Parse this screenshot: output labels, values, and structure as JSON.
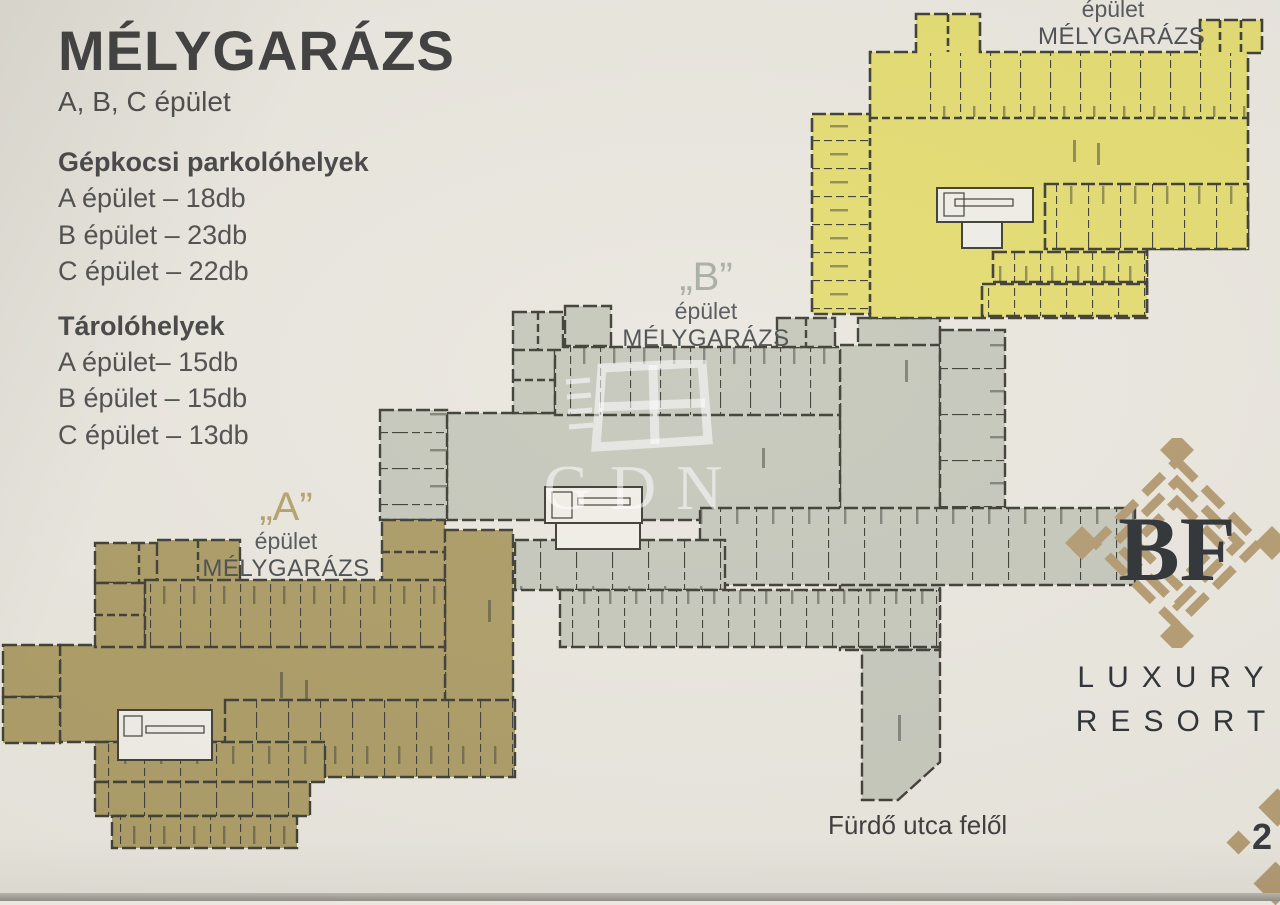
{
  "info_panel": {
    "title": "MÉLYGARÁZS",
    "subtitle": "A, B, C épület",
    "parking": {
      "heading": "Gépkocsi parkolóhelyek",
      "items": [
        "A épület – 18db",
        "B épület – 23db",
        "C épület – 22db"
      ]
    },
    "storage": {
      "heading": "Tárolóhelyek",
      "items": [
        "A épület– 15db",
        "B épület – 15db",
        "C épület – 13db"
      ]
    }
  },
  "plan_labels": {
    "a": {
      "letter": "„A”",
      "building": "épület",
      "name": "MÉLYGARÁZS"
    },
    "b": {
      "letter": "„B”",
      "building": "épület",
      "name": "MÉLYGARÁZS"
    },
    "c": {
      "building": "épület",
      "name": "MÉLYGARÁZS"
    }
  },
  "street_label": "Fürdő utca felől",
  "watermark_text": "GDN",
  "logo": {
    "monogram": "BF",
    "word1": "LUXURY",
    "word2": "RESORT"
  },
  "page_number": "2",
  "legend_colors": {
    "building_a": "#ac9c66",
    "building_b": "#c6c8bc",
    "building_c": "#e4dc72",
    "walls": "#3e3e35",
    "background": "#eae7df",
    "logo_tan": "#b49b72"
  }
}
